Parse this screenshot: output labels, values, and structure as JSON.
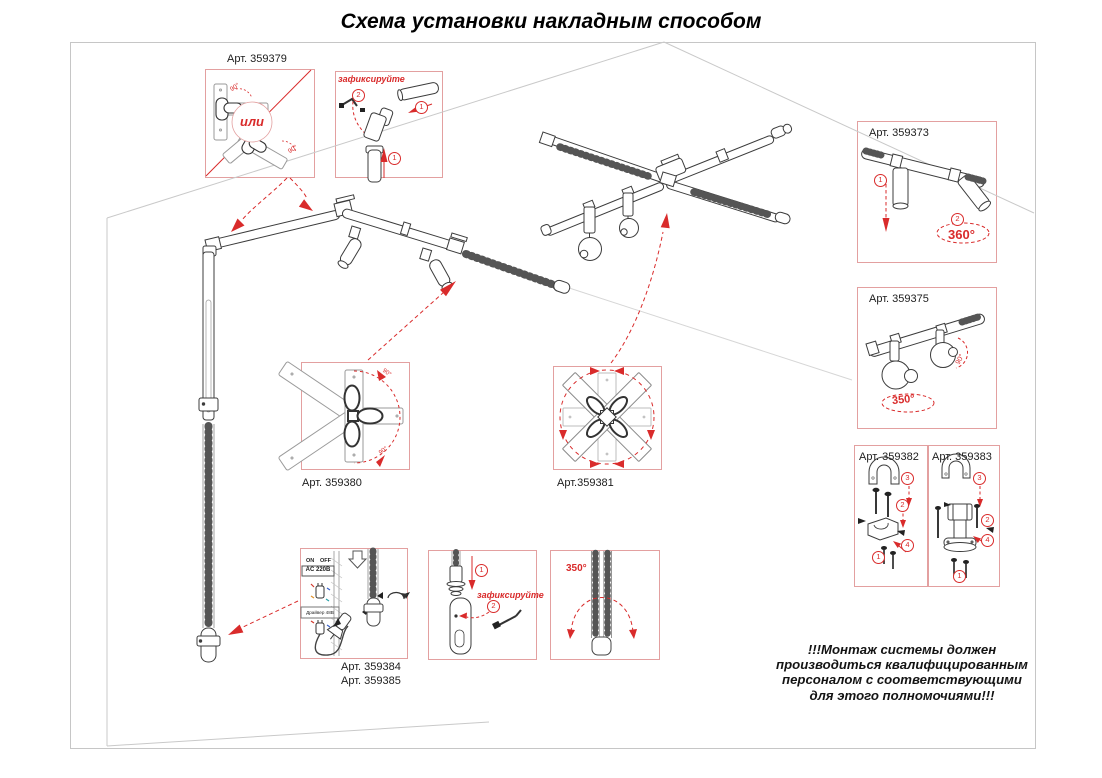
{
  "title": "Схема установки накладным способом",
  "colors": {
    "accent_red": "#d92b2b",
    "callout_border": "#e3a0a0",
    "line_dark": "#3c3c3c",
    "line_light": "#c9c9c9",
    "warning_text": "#141414"
  },
  "steps": {
    "s1": "1",
    "s2": "2",
    "s3": "3",
    "s4": "4"
  },
  "angles": {
    "deg90": "90°",
    "deg350": "350°",
    "deg360": "360°"
  },
  "callouts": {
    "c379": {
      "label": "Арт. 359379",
      "or_label": "или"
    },
    "fix_top": {
      "label": "зафиксируйте"
    },
    "c373": {
      "label": "Арт. 359373"
    },
    "c375": {
      "label": "Арт. 359375"
    },
    "c380": {
      "label": "Арт. 359380"
    },
    "c381": {
      "label": "Арт.359381"
    },
    "c382": {
      "label": "Арт. 359382"
    },
    "c383": {
      "label": "Арт. 359383"
    },
    "c384_385": {
      "label_line1": "Арт. 359384",
      "label_line2": "Арт. 359385",
      "switch_on": "ON",
      "switch_off": "OFF",
      "power": "AC 220В",
      "driver": "Драйвер 48В"
    },
    "fix_bottom": {
      "label": "зафиксируйте"
    },
    "rotate_box": {
      "angle": "350°"
    }
  },
  "warning": {
    "lines": [
      "!!!Монтаж системы должен",
      "производиться квалифицированным",
      "персоналом с соответствующими",
      "для этого полномочиями!!!"
    ]
  }
}
